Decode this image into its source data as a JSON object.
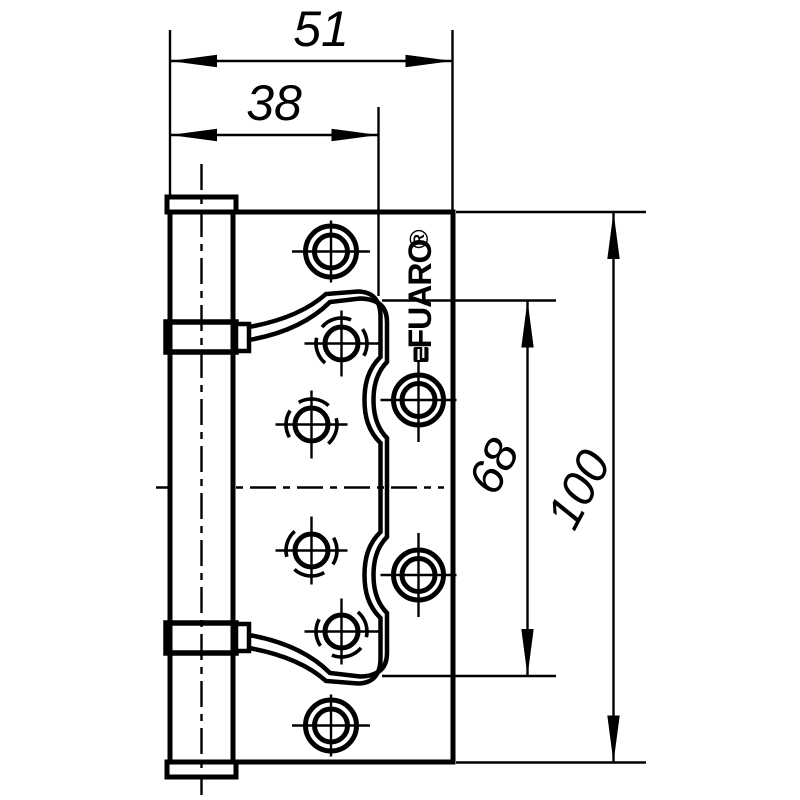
{
  "drawing": {
    "type": "hinge-technical-drawing",
    "colors": {
      "line": "#000000",
      "background": "#ffffff"
    },
    "dimensions": {
      "total_width": "51",
      "leaf_width": "38",
      "hole_span": "68",
      "height": "100"
    },
    "brand": {
      "name": "FUARO",
      "registered_mark": "®"
    },
    "screw_hole_count": 8
  }
}
